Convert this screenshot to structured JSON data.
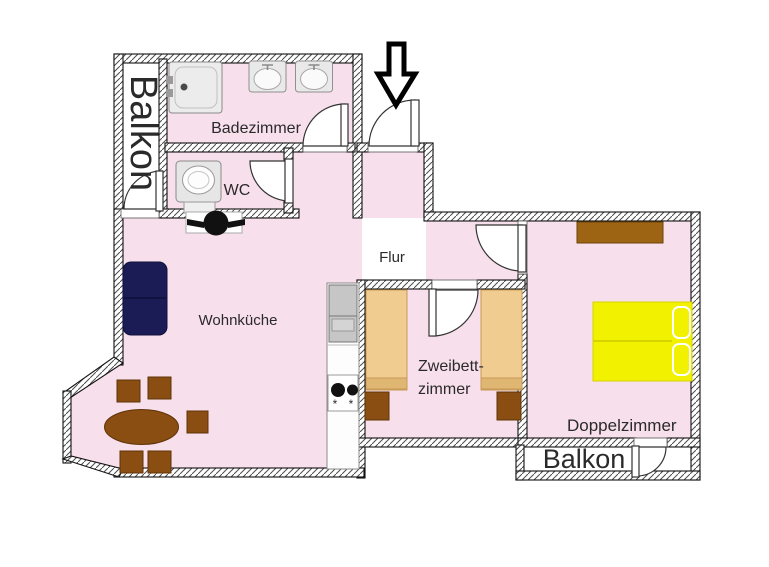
{
  "app": {
    "type": "apartment-floor-plan"
  },
  "labels": {
    "balkon_left": "Balkon",
    "badezimmer": "Badezimmer",
    "wc": "WC",
    "flur": "Flur",
    "wohnkueche": "Wohnküche",
    "zweibett_line1": "Zweibett-",
    "zweibett_line2": "zimmer",
    "doppelzimmer": "Doppelzimmer",
    "balkon_bottom": "Balkon",
    "stove_mark": "*"
  },
  "colors": {
    "floor_pink": "#f8dfec",
    "bed_tan": "#f0cc90",
    "furniture_brown": "#8a4d12",
    "sofa_navy": "#1b1b55",
    "bed_yellow": "#f2f100",
    "wardrobe_brown": "#9d6413",
    "appliance_gray": "#c6c6c6"
  }
}
